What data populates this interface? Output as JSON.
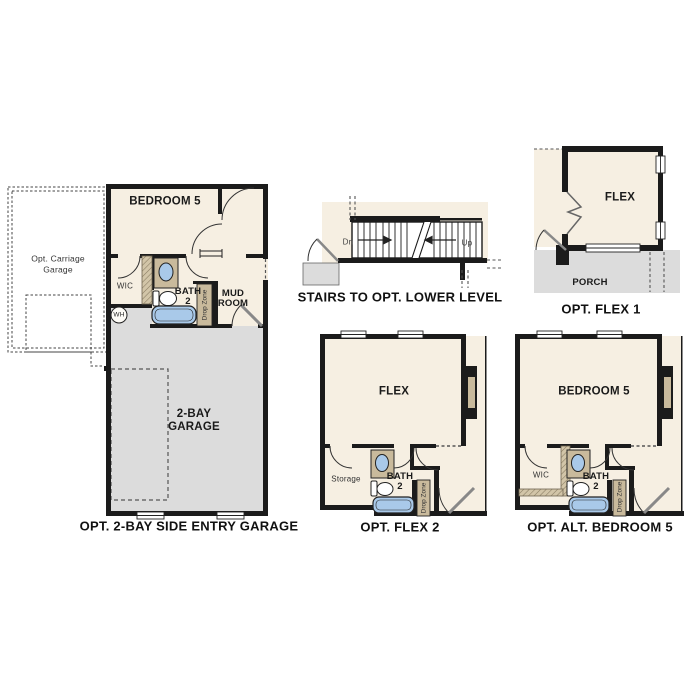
{
  "document": {
    "background": "#ffffff",
    "type": "floor-plan-options-sheet"
  },
  "colors": {
    "floor_cream": "#f6efe2",
    "garage_gray": "#dcdcdc",
    "wall_black": "#1b1b1b",
    "cabinet_tan": "#c9ba9c",
    "fixture_blue": "#a9c9e9"
  },
  "plans": {
    "side_entry_garage": {
      "caption": "OPT. 2-BAY SIDE ENTRY GARAGE",
      "labels": {
        "bedroom": "BEDROOM 5",
        "carriage_garage": "Opt. Carriage\nGarage",
        "wic": "WIC",
        "bath": "BATH\n2",
        "mud_room": "MUD\nROOM",
        "drop_zone": "Drop Zone",
        "water_heater": "WH",
        "garage": "2-BAY\nGARAGE"
      }
    },
    "stairs": {
      "caption": "STAIRS TO OPT. LOWER LEVEL",
      "labels": {
        "down": "Dn",
        "up": "Up"
      }
    },
    "flex1": {
      "caption": "OPT. FLEX 1",
      "labels": {
        "flex": "FLEX",
        "porch": "PORCH"
      }
    },
    "flex2": {
      "caption": "OPT. FLEX 2",
      "labels": {
        "flex": "FLEX",
        "storage": "Storage",
        "bath": "BATH\n2",
        "drop_zone": "Drop Zone"
      }
    },
    "alt_bedroom5": {
      "caption": "OPT. ALT. BEDROOM 5",
      "labels": {
        "bedroom": "BEDROOM 5",
        "wic": "WIC",
        "bath": "BATH\n2",
        "drop_zone": "Drop Zone"
      }
    }
  }
}
